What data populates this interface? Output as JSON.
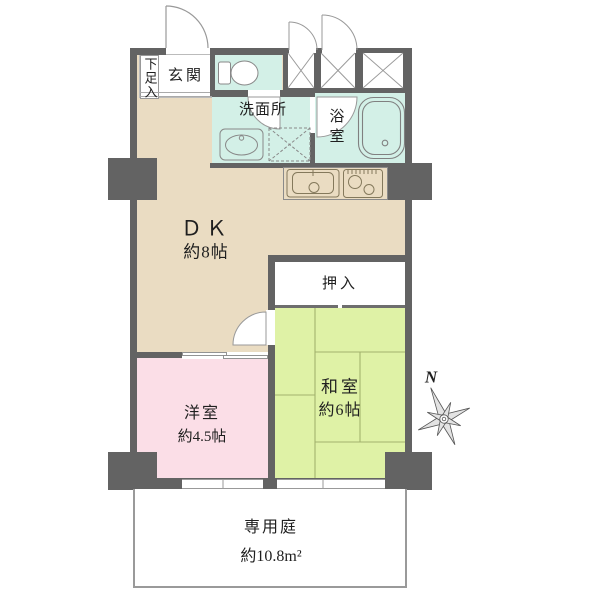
{
  "colors": {
    "wall": "#636363",
    "dk_floor": "#EADCC2",
    "wet_floor": "#D3F0E7",
    "tatami_floor": "#DFF2A6",
    "western_floor": "#FBDEE7",
    "outline": "#999999",
    "text": "#1F1F1F"
  },
  "rooms": {
    "shoe_box": {
      "label": "下足入"
    },
    "entrance": {
      "label": "玄関"
    },
    "washroom": {
      "label": "洗面所"
    },
    "bathroom": {
      "label": "浴室"
    },
    "dining_kitchen": {
      "label": "ＤＫ",
      "size": "約8帖"
    },
    "closet": {
      "label": "押入"
    },
    "japanese_room": {
      "label": "和室",
      "size": "約6帖"
    },
    "western_room": {
      "label": "洋室",
      "size": "約4.5帖"
    },
    "private_garden": {
      "label": "専用庭",
      "size": "約10.8m²"
    }
  },
  "compass": {
    "label": "N"
  },
  "icons": {
    "toilet": "toilet-icon",
    "vanity_sink": "vanity-sink-icon",
    "washer_space": "washer-space-icon",
    "bathtub": "bathtub-icon",
    "kitchen_sink": "kitchen-sink-icon",
    "stove": "stove-icon",
    "compass_rose": "compass-rose-icon"
  }
}
